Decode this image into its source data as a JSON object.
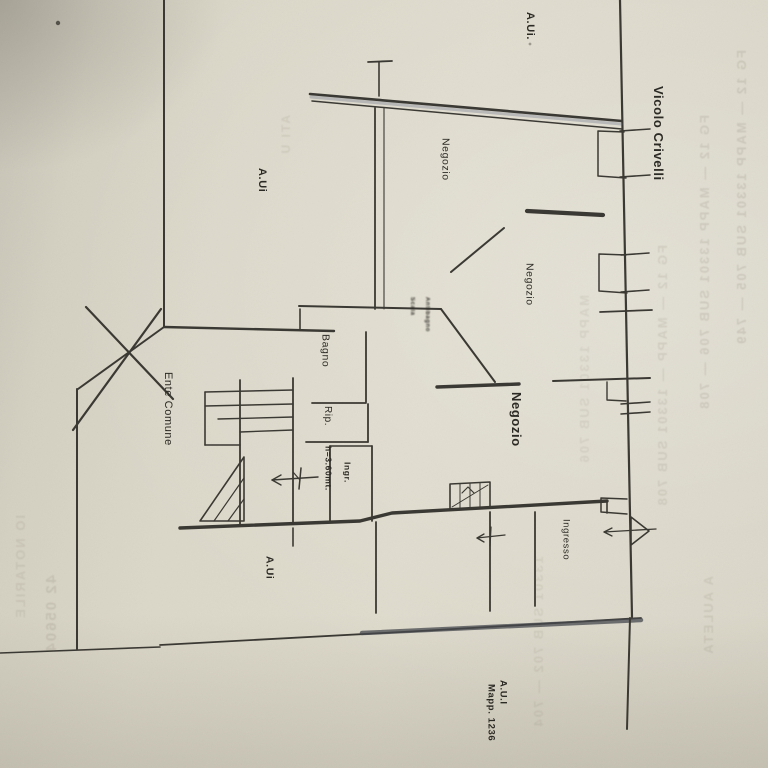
{
  "street_label": "Vicolo Crivelli",
  "colors": {
    "paper": "#d8d4c6",
    "ink": "#3b3933",
    "label_ink": "#2c2a24",
    "blue_tint": "#5d6880",
    "ghost": "#6d6654"
  },
  "labels": [
    {
      "id": "aui-top",
      "text": "A.Ui.",
      "x": 524,
      "y": 12,
      "size": 11,
      "weight": 700
    },
    {
      "id": "vicolo-crivelli",
      "text": "Vicolo Crivelli",
      "x": 652,
      "y": 86,
      "size": 13,
      "weight": 700
    },
    {
      "id": "aui-upper-left",
      "text": "A.Ui",
      "x": 256,
      "y": 168,
      "size": 11,
      "weight": 700
    },
    {
      "id": "negozio-top",
      "text": "Negozio",
      "x": 440,
      "y": 138,
      "size": 10.5,
      "weight": 400
    },
    {
      "id": "negozio-mid",
      "text": "Negozio",
      "x": 524,
      "y": 263,
      "size": 10.5,
      "weight": 400
    },
    {
      "id": "bagno",
      "text": "Bagno",
      "x": 320,
      "y": 334,
      "size": 10.5,
      "weight": 400
    },
    {
      "id": "scala",
      "text": "Scala",
      "x": 409,
      "y": 297,
      "size": 6,
      "weight": 700,
      "smudge": true
    },
    {
      "id": "antibagno",
      "text": "Antibagno",
      "x": 424,
      "y": 297,
      "size": 6,
      "weight": 700,
      "smudge": true
    },
    {
      "id": "rip",
      "text": "Rip.",
      "x": 322,
      "y": 406,
      "size": 10,
      "weight": 400
    },
    {
      "id": "altezza",
      "text": "h=3.60mt.",
      "x": 324,
      "y": 446,
      "size": 8.5,
      "weight": 700
    },
    {
      "id": "ingr",
      "text": "Ingr.",
      "x": 343,
      "y": 462,
      "size": 8.5,
      "weight": 700
    },
    {
      "id": "ente-comune",
      "text": "Ente Comune",
      "x": 162,
      "y": 372,
      "size": 11,
      "weight": 400
    },
    {
      "id": "negozio-big",
      "text": "Negozio",
      "x": 510,
      "y": 392,
      "size": 13,
      "weight": 600
    },
    {
      "id": "ingresso",
      "text": "Ingresso",
      "x": 561,
      "y": 519,
      "size": 9.5,
      "weight": 400
    },
    {
      "id": "aui-bottom",
      "text": "A.Ui",
      "x": 264,
      "y": 556,
      "size": 10.5,
      "weight": 700
    },
    {
      "id": "aui-br",
      "text": "A.U.I",
      "x": 498,
      "y": 680,
      "size": 9.5,
      "weight": 700
    },
    {
      "id": "mapp-1236",
      "text": "Mapp. 1236",
      "x": 486,
      "y": 684,
      "size": 9.5,
      "weight": 700
    }
  ],
  "ghost_texts": [
    {
      "id": "g1",
      "text": "FG 12 — MAPP 13301 SUB 705 — 749",
      "x": 735,
      "y": 50,
      "size": 13,
      "opacity": 0.16
    },
    {
      "id": "g2",
      "text": "FG 12 — MAPP 13301 SUB 706 — 708",
      "x": 698,
      "y": 115,
      "size": 13,
      "opacity": 0.15
    },
    {
      "id": "g3",
      "text": "FG 12 — MAPP — 13301 SUB 708",
      "x": 656,
      "y": 245,
      "size": 13,
      "opacity": 0.13
    },
    {
      "id": "g4",
      "text": "MAPP 13301 SUB 706",
      "x": 578,
      "y": 295,
      "size": 13,
      "opacity": 0.1
    },
    {
      "id": "g5",
      "text": "13301 SUB 702 — 704",
      "x": 532,
      "y": 556,
      "size": 13,
      "opacity": 0.11
    },
    {
      "id": "g6",
      "text": "A AULETA",
      "x": 702,
      "y": 576,
      "size": 13,
      "opacity": 0.13
    },
    {
      "id": "g7",
      "text": "42 05604",
      "x": 44,
      "y": 575,
      "size": 15,
      "opacity": 0.15
    },
    {
      "id": "g8",
      "text": "IO NOTARILE",
      "x": 14,
      "y": 515,
      "size": 13,
      "opacity": 0.11
    },
    {
      "id": "g9",
      "text": "ATI U",
      "x": 280,
      "y": 115,
      "size": 12,
      "opacity": 0.12
    }
  ]
}
